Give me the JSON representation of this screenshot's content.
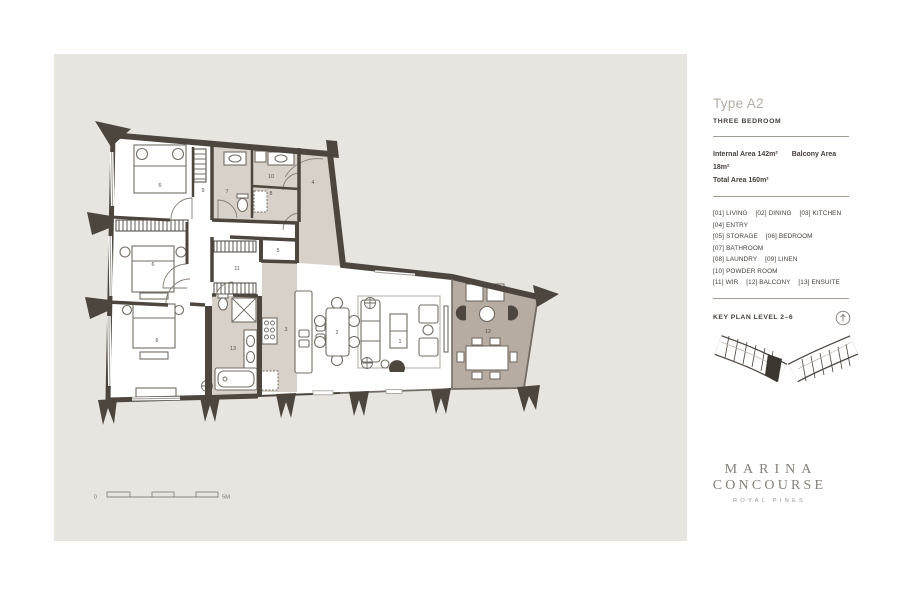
{
  "plan": {
    "rooms": [
      {
        "number": "1",
        "name": "LIVING"
      },
      {
        "number": "2",
        "name": "DINING"
      },
      {
        "number": "3",
        "name": "KITCHEN"
      },
      {
        "number": "4",
        "name": "ENTRY"
      },
      {
        "number": "5",
        "name": "STORAGE"
      },
      {
        "number": "6",
        "name": "BEDROOM"
      },
      {
        "number": "6",
        "name": "BEDROOM"
      },
      {
        "number": "6",
        "name": "BEDROOM"
      },
      {
        "number": "7",
        "name": "BATHROOM"
      },
      {
        "number": "8",
        "name": "LAUNDRY"
      },
      {
        "number": "9",
        "name": "LINEN"
      },
      {
        "number": "10",
        "name": "POWDER ROOM"
      },
      {
        "number": "11",
        "name": "WIR"
      },
      {
        "number": "12",
        "name": "BALCONY"
      },
      {
        "number": "13",
        "name": "ENSUITE"
      }
    ],
    "scale_bar": {
      "start_label": "0",
      "end_label": "5M"
    }
  },
  "sidebar": {
    "type_title": "Type A2",
    "subtitle": "THREE BEDROOM",
    "areas": {
      "internal_label": "Internal Area 142m²",
      "balcony_label": "Balcony Area 18m²",
      "total_label": "Total Area 160m²"
    },
    "legend": {
      "items": [
        {
          "code": "[01]",
          "label": "LIVING"
        },
        {
          "code": "[02]",
          "label": "DINING"
        },
        {
          "code": "[03]",
          "label": "KITCHEN"
        },
        {
          "code": "[04]",
          "label": "ENTRY"
        },
        {
          "code": "[05]",
          "label": "STORAGE"
        },
        {
          "code": "[06]",
          "label": "BEDROOM"
        },
        {
          "code": "[07]",
          "label": "BATHROOM"
        },
        {
          "code": "[08]",
          "label": "LAUNDRY"
        },
        {
          "code": "[09]",
          "label": "LINEN"
        },
        {
          "code": "[10]",
          "label": "POWDER ROOM"
        },
        {
          "code": "[11]",
          "label": "WIR"
        },
        {
          "code": "[12]",
          "label": "BALCONY"
        },
        {
          "code": "[13]",
          "label": "ENSUITE"
        }
      ]
    },
    "key_plan": {
      "label": "KEY PLAN LEVEL 2–6"
    }
  },
  "logo": {
    "line1": "MARINA",
    "line2": "CONCOURSE",
    "subtitle": "ROYAL PINES"
  },
  "colors": {
    "panel_bg": "#e8e4df",
    "wall": "#4c463f",
    "wet_area_shade": "#d8d1c9",
    "balcony_shade": "#b6aca2",
    "text_dark": "#45403a",
    "text_muted": "#b4aba2",
    "logo": "#85807a"
  }
}
